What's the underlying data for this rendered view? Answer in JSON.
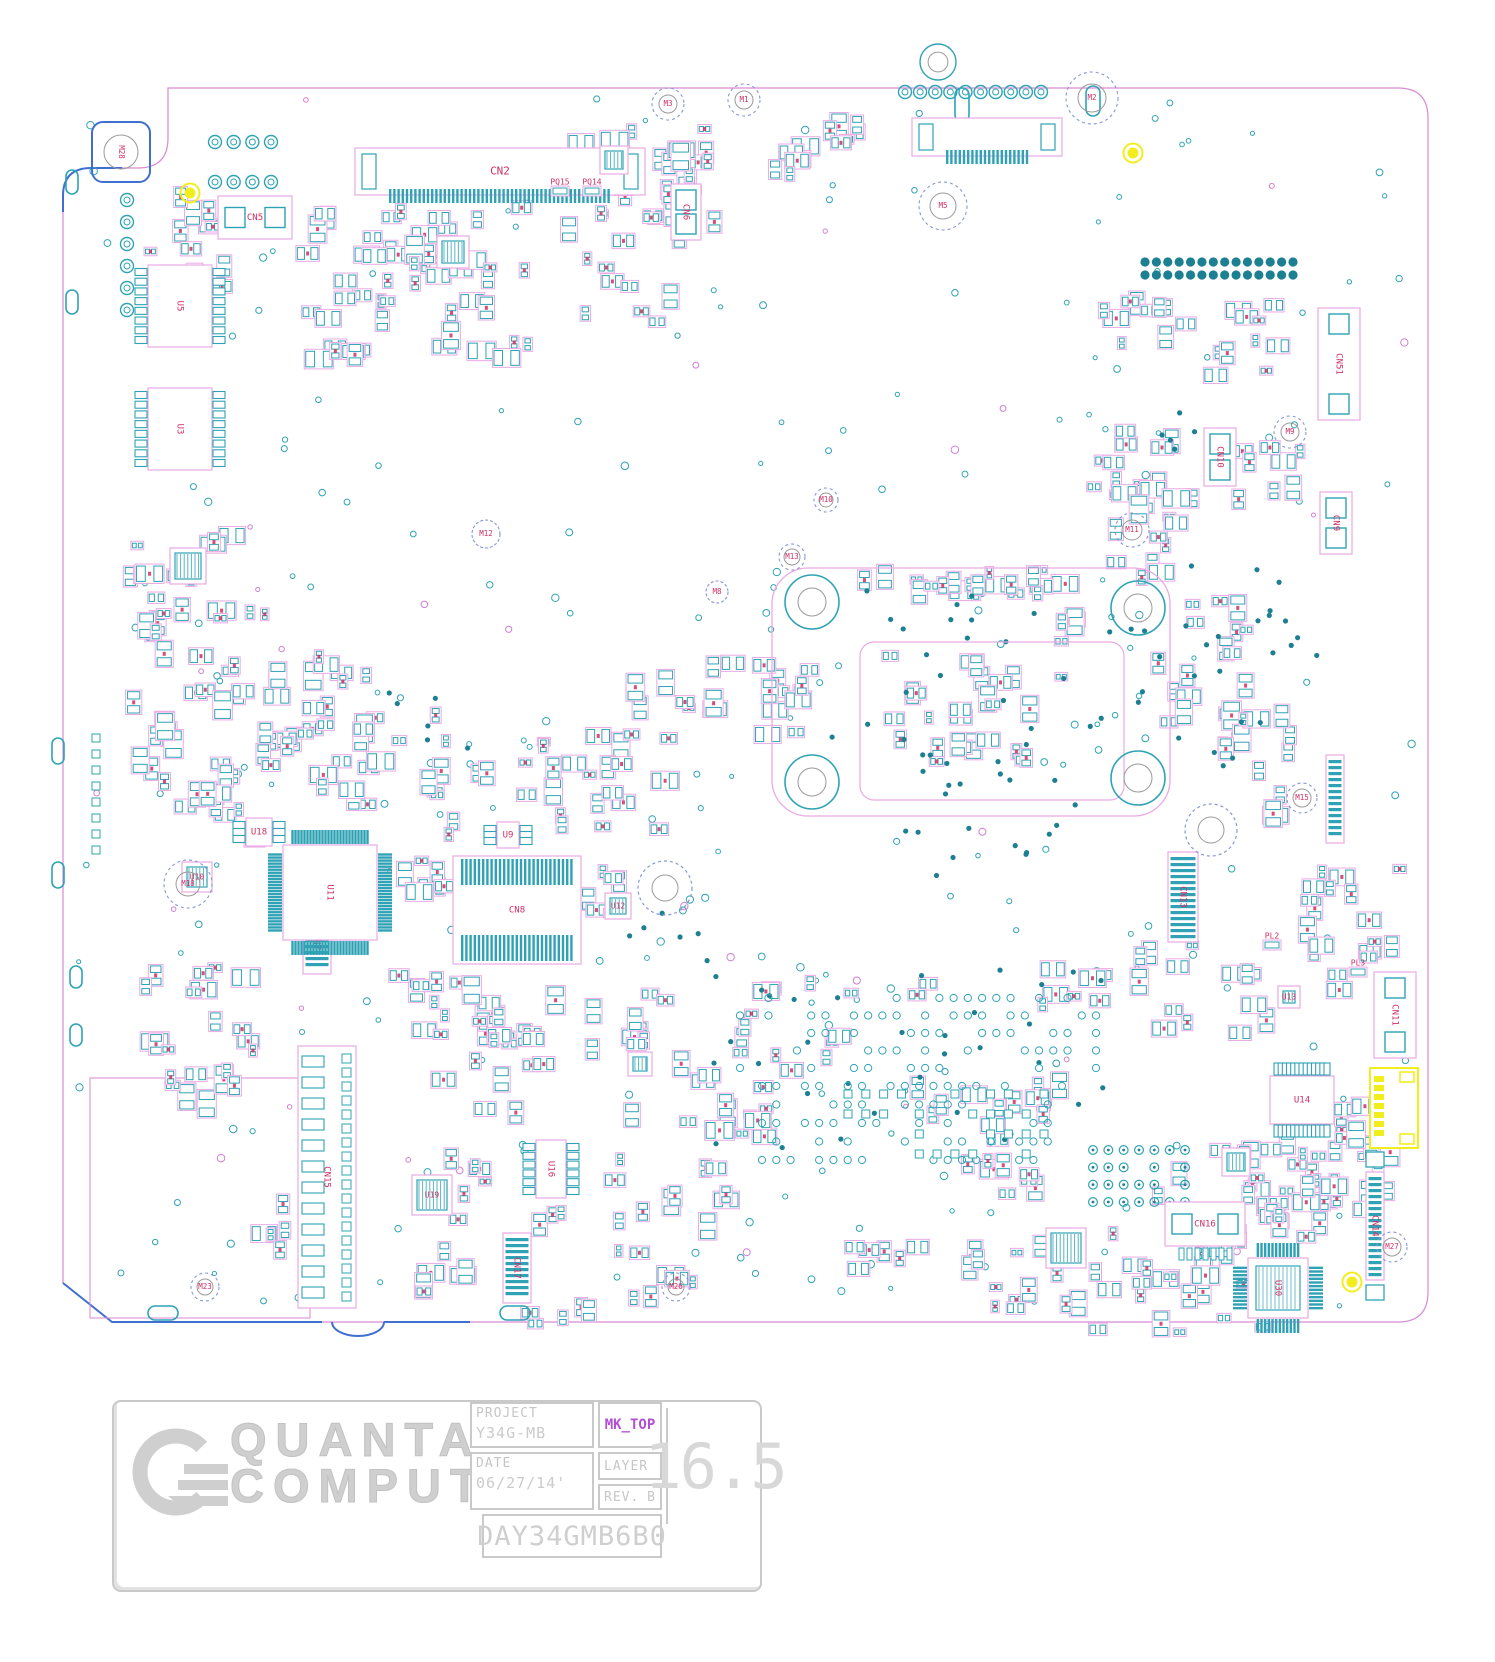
{
  "title_block": {
    "company_line1": "QUANTA",
    "company_line2": "COMPUTER",
    "project_label": "PROJECT",
    "project_value": "Y34G-MB",
    "view_name": "MK_TOP",
    "date_label": "DATE",
    "date_value": "06/27/14'",
    "layer_label": "LAYER",
    "rev_label": "REV.",
    "rev_value": "B",
    "scale_value": "16.5",
    "board_number": "DAY34GMB6B0"
  },
  "colors": {
    "pad": "#2fa3b5",
    "pad_dark": "#1d7f92",
    "silk": "#eaaae4",
    "silk2": "#cf7fd2",
    "ref": "#d02e63",
    "outline": "#d98ad4",
    "edge_blue": "#3f6fd0",
    "hole_dash": "#8896d8",
    "hole_inner": "#9a9a9a",
    "yellow": "#f2ee1e"
  },
  "board": {
    "outline": {
      "path": "M168,88 H1398 Q1428,88 1428,118 V1292 Q1428,1322 1398,1322 H112 L63,1283 V196 Q63,168 91,168 H138 Q168,168 168,138 Z",
      "blue": [
        "M63,1283 L112,1322 H322",
        "M332,1322 a26,14 0 0 0 52,0",
        "M384,1322 H470",
        "M63,212 V196 Q63,168 91,168 H122"
      ]
    },
    "zones": [
      {
        "x": 90,
        "y": 1078,
        "w": 220,
        "h": 240
      }
    ],
    "cpu_area": {
      "outer": {
        "x": 772,
        "y": 568,
        "w": 398,
        "h": 248,
        "rx": 36
      },
      "inner": {
        "x": 860,
        "y": 642,
        "w": 264,
        "h": 158,
        "rx": 14
      },
      "holes": [
        [
          812,
          602
        ],
        [
          1138,
          608
        ],
        [
          812,
          782
        ],
        [
          1138,
          778
        ]
      ],
      "hole_r1": 27,
      "hole_r2": 14
    },
    "mounting_holes": [
      {
        "label": "M28",
        "x": 121,
        "y": 152,
        "style": "pad"
      },
      {
        "label": "M3",
        "x": 668,
        "y": 104,
        "style": "a",
        "r1": 16,
        "r2": 9
      },
      {
        "label": "M1",
        "x": 744,
        "y": 100,
        "style": "a",
        "r1": 16,
        "r2": 9
      },
      {
        "label": "M2",
        "x": 1092,
        "y": 98,
        "style": "b",
        "r1": 26,
        "r2": 14
      },
      {
        "label": "M5",
        "x": 943,
        "y": 206,
        "style": "b",
        "r1": 24,
        "r2": 13
      },
      {
        "label": "M12",
        "x": 486,
        "y": 534,
        "style": "c",
        "r1": 14
      },
      {
        "label": "M13",
        "x": 792,
        "y": 557,
        "style": "a",
        "r1": 13,
        "r2": 8
      },
      {
        "label": "M10",
        "x": 826,
        "y": 500,
        "style": "a",
        "r1": 12,
        "r2": 7
      },
      {
        "label": "M11",
        "x": 1132,
        "y": 530,
        "style": "b",
        "r1": 17,
        "r2": 10
      },
      {
        "label": "M9",
        "x": 1290,
        "y": 432,
        "style": "b",
        "r1": 16,
        "r2": 9
      },
      {
        "label": "M8",
        "x": 717,
        "y": 592,
        "style": "c",
        "r1": 11
      },
      {
        "label": "M15",
        "x": 1302,
        "y": 798,
        "style": "a",
        "r1": 15,
        "r2": 9
      },
      {
        "label": "M18",
        "x": 188,
        "y": 884,
        "style": "b",
        "r1": 24,
        "r2": 12
      },
      {
        "label": "M23",
        "x": 205,
        "y": 1287,
        "style": "a",
        "r1": 14,
        "r2": 8
      },
      {
        "label": "M26",
        "x": 676,
        "y": 1287,
        "style": "a",
        "r1": 14,
        "r2": 8
      },
      {
        "label": "M27",
        "x": 1392,
        "y": 1247,
        "style": "a",
        "r1": 15,
        "r2": 9
      },
      {
        "label": "",
        "x": 1211,
        "y": 830,
        "style": "big",
        "r1": 26,
        "r2": 13
      },
      {
        "label": "",
        "x": 665,
        "y": 888,
        "style": "big",
        "r1": 27,
        "r2": 13
      }
    ],
    "fiducials": [
      [
        190,
        193
      ],
      [
        1133,
        153
      ],
      [
        1352,
        1282
      ]
    ],
    "rings": [
      [
        938,
        62,
        18
      ]
    ],
    "slots": [
      {
        "x": 66,
        "y": 170,
        "w": 12,
        "h": 24
      },
      {
        "x": 66,
        "y": 290,
        "w": 12,
        "h": 24
      },
      {
        "x": 52,
        "y": 738,
        "w": 12,
        "h": 26
      },
      {
        "x": 52,
        "y": 862,
        "w": 12,
        "h": 26
      },
      {
        "x": 70,
        "y": 966,
        "w": 12,
        "h": 22
      },
      {
        "x": 70,
        "y": 1024,
        "w": 12,
        "h": 22
      },
      {
        "x": 148,
        "y": 1306,
        "w": 30,
        "h": 14
      },
      {
        "x": 500,
        "y": 1306,
        "w": 30,
        "h": 14
      },
      {
        "x": 955,
        "y": 88,
        "w": 14,
        "h": 34
      },
      {
        "x": 1086,
        "y": 86,
        "w": 14,
        "h": 30
      }
    ],
    "connectors": [
      {
        "t": "CN2",
        "type": "ffc_h",
        "x": 355,
        "y": 148,
        "w": 290,
        "h": 47
      },
      {
        "t": "CN5",
        "type": "box_h",
        "x": 218,
        "y": 196,
        "w": 74,
        "h": 43
      },
      {
        "t": "CN6",
        "type": "box_v",
        "x": 671,
        "y": 184,
        "w": 30,
        "h": 56,
        "r": 1
      },
      {
        "t": "",
        "type": "ffc_h",
        "x": 912,
        "y": 118,
        "w": 150,
        "h": 38
      },
      {
        "t": "CN51",
        "type": "box_v",
        "x": 1318,
        "y": 308,
        "w": 42,
        "h": 112,
        "r": 1
      },
      {
        "t": "CN10",
        "type": "box_v",
        "x": 1204,
        "y": 428,
        "w": 32,
        "h": 58,
        "r": 1
      },
      {
        "t": "CN9",
        "type": "box_v",
        "x": 1320,
        "y": 492,
        "w": 32,
        "h": 62,
        "r": 1
      },
      {
        "t": "CN8",
        "type": "dual_comb",
        "x": 453,
        "y": 856,
        "w": 128,
        "h": 108
      },
      {
        "t": "CN7",
        "type": "ffc_v",
        "x": 303,
        "y": 910,
        "w": 28,
        "h": 64,
        "r": 1
      },
      {
        "t": "CN15",
        "type": "tall_v",
        "x": 298,
        "y": 1046,
        "w": 58,
        "h": 262,
        "r": 1
      },
      {
        "t": "CN13",
        "type": "ffc_v",
        "x": 1168,
        "y": 852,
        "w": 30,
        "h": 90,
        "r": 1
      },
      {
        "t": "",
        "type": "ffc_v",
        "x": 1326,
        "y": 755,
        "w": 18,
        "h": 88
      },
      {
        "t": "CN11",
        "type": "box_v",
        "x": 1374,
        "y": 972,
        "w": 42,
        "h": 86,
        "r": 1
      },
      {
        "t": "CN16",
        "type": "box_h",
        "x": 1165,
        "y": 1202,
        "w": 80,
        "h": 44
      },
      {
        "t": "CN14",
        "type": "ffc_v",
        "x": 1366,
        "y": 1172,
        "w": 18,
        "h": 108,
        "r": 1,
        "e": 1
      },
      {
        "t": "CN17",
        "type": "ffc_v",
        "x": 503,
        "y": 1233,
        "w": 28,
        "h": 70,
        "r": 1
      },
      {
        "t": "",
        "type": "yellow_box",
        "x": 1370,
        "y": 1068,
        "w": 48,
        "h": 80
      }
    ],
    "ics": [
      {
        "t": "U5",
        "type": "soic",
        "x": 148,
        "y": 265,
        "w": 64,
        "h": 82,
        "p": 8,
        "o": "v",
        "r": 1
      },
      {
        "t": "U3",
        "type": "soic",
        "x": 148,
        "y": 388,
        "w": 64,
        "h": 82,
        "p": 8,
        "o": "v",
        "r": 1
      },
      {
        "t": "U11",
        "type": "qfp",
        "x": 283,
        "y": 845,
        "w": 94,
        "h": 95,
        "p": 26,
        "r": 1
      },
      {
        "t": "U30",
        "type": "qfp",
        "x": 1248,
        "y": 1258,
        "w": 60,
        "h": 60,
        "p": 12,
        "f": 1,
        "r": 1
      },
      {
        "t": "U9",
        "type": "soic",
        "x": 497,
        "y": 822,
        "w": 22,
        "h": 26,
        "p": 3,
        "o": "v"
      },
      {
        "t": "U18",
        "type": "soic",
        "x": 246,
        "y": 818,
        "w": 26,
        "h": 28,
        "p": 3,
        "o": "v"
      },
      {
        "t": "U10",
        "type": "qfn",
        "x": 182,
        "y": 862,
        "s": 30
      },
      {
        "t": "U12",
        "type": "qfn",
        "x": 605,
        "y": 893,
        "s": 26
      },
      {
        "t": "U13",
        "type": "qfn",
        "x": 1278,
        "y": 986,
        "s": 22
      },
      {
        "t": "U14",
        "type": "soic",
        "x": 1270,
        "y": 1076,
        "w": 64,
        "h": 48,
        "p": 13,
        "o": "h"
      },
      {
        "t": "U19",
        "type": "qfn",
        "x": 412,
        "y": 1175,
        "s": 40
      },
      {
        "t": "U16",
        "type": "soic",
        "x": 536,
        "y": 1140,
        "w": 30,
        "h": 58,
        "p": 6,
        "o": "v",
        "r": 1
      },
      {
        "t": "",
        "type": "qfn",
        "x": 437,
        "y": 236,
        "s": 32
      },
      {
        "t": "",
        "type": "qfn",
        "x": 600,
        "y": 146,
        "s": 28
      },
      {
        "t": "",
        "type": "qfn",
        "x": 170,
        "y": 548,
        "s": 36
      },
      {
        "t": "",
        "type": "qfn",
        "x": 1046,
        "y": 1228,
        "s": 40
      },
      {
        "t": "",
        "type": "qfn",
        "x": 1222,
        "y": 1148,
        "s": 28
      },
      {
        "t": "",
        "type": "qfn",
        "x": 628,
        "y": 1052,
        "s": 24
      }
    ],
    "small_labels": [
      {
        "t": "PQ15",
        "x": 560,
        "y": 182
      },
      {
        "t": "PQ14",
        "x": 592,
        "y": 182
      },
      {
        "t": "PL2",
        "x": 1272,
        "y": 936
      },
      {
        "t": "PL3",
        "x": 1358,
        "y": 963
      }
    ],
    "pad_grids": [
      {
        "x": 740,
        "y": 998,
        "w": 356,
        "h": 70,
        "r": 5,
        "c": 26,
        "s": "dot",
        "p": 0.5
      },
      {
        "x": 762,
        "y": 1086,
        "w": 300,
        "h": 74,
        "r": 5,
        "c": 22,
        "s": "dot",
        "p": 0.5
      },
      {
        "x": 848,
        "y": 1094,
        "w": 196,
        "h": 60,
        "r": 4,
        "c": 12,
        "s": "sq",
        "p": 0.55
      },
      {
        "x": 1093,
        "y": 1150,
        "w": 92,
        "h": 52,
        "r": 4,
        "c": 7,
        "s": "tg",
        "p": 0.85
      },
      {
        "x": 215,
        "y": 142,
        "w": 56,
        "h": 40,
        "r": 2,
        "c": 4,
        "s": "ring",
        "p": 1
      },
      {
        "x": 905,
        "y": 92,
        "w": 136,
        "h": 12,
        "r": 1,
        "c": 10,
        "s": "ring",
        "p": 1
      },
      {
        "x": 1145,
        "y": 262,
        "w": 148,
        "h": 13,
        "r": 2,
        "c": 14,
        "s": "fdot",
        "p": 1
      },
      {
        "x": 127,
        "y": 200,
        "w": 10,
        "h": 110,
        "r": 6,
        "c": 1,
        "s": "ring",
        "p": 1
      },
      {
        "x": 96,
        "y": 738,
        "w": 14,
        "h": 112,
        "r": 8,
        "c": 1,
        "s": "sq",
        "p": 1
      }
    ],
    "clusters": [
      [
        130,
        185,
        110,
        120,
        12
      ],
      [
        285,
        205,
        180,
        110,
        18
      ],
      [
        390,
        200,
        150,
        90,
        16
      ],
      [
        560,
        120,
        120,
        130,
        18
      ],
      [
        662,
        120,
        70,
        100,
        10
      ],
      [
        755,
        130,
        70,
        60,
        6
      ],
      [
        815,
        110,
        60,
        50,
        6
      ],
      [
        1090,
        280,
        110,
        70,
        10
      ],
      [
        1195,
        295,
        100,
        90,
        10
      ],
      [
        1080,
        420,
        110,
        110,
        12
      ],
      [
        1100,
        480,
        100,
        70,
        8
      ],
      [
        1230,
        440,
        80,
        80,
        8
      ],
      [
        120,
        520,
        130,
        130,
        16
      ],
      [
        150,
        590,
        120,
        120,
        14
      ],
      [
        230,
        645,
        150,
        110,
        16
      ],
      [
        120,
        690,
        130,
        120,
        14
      ],
      [
        250,
        705,
        150,
        110,
        16
      ],
      [
        345,
        700,
        110,
        100,
        10
      ],
      [
        440,
        730,
        130,
        120,
        12
      ],
      [
        555,
        720,
        130,
        120,
        14
      ],
      [
        620,
        660,
        110,
        90,
        8
      ],
      [
        700,
        650,
        110,
        110,
        10
      ],
      [
        850,
        560,
        240,
        50,
        14
      ],
      [
        880,
        650,
        230,
        130,
        26
      ],
      [
        1150,
        650,
        120,
        110,
        10
      ],
      [
        1200,
        700,
        130,
        130,
        12
      ],
      [
        1185,
        560,
        90,
        110,
        8
      ],
      [
        380,
        950,
        150,
        110,
        12
      ],
      [
        440,
        975,
        130,
        80,
        10
      ],
      [
        420,
        1020,
        150,
        110,
        12
      ],
      [
        560,
        980,
        120,
        90,
        8
      ],
      [
        620,
        1030,
        130,
        120,
        10
      ],
      [
        600,
        1150,
        150,
        110,
        14
      ],
      [
        130,
        950,
        140,
        110,
        12
      ],
      [
        150,
        1020,
        120,
        100,
        10
      ],
      [
        1130,
        940,
        150,
        110,
        14
      ],
      [
        1290,
        860,
        120,
        90,
        10
      ],
      [
        1300,
        930,
        100,
        70,
        8
      ],
      [
        1150,
        1130,
        190,
        100,
        18
      ],
      [
        1230,
        1140,
        170,
        110,
        20
      ],
      [
        1080,
        1220,
        200,
        120,
        26
      ],
      [
        950,
        1230,
        140,
        90,
        14
      ],
      [
        1290,
        1090,
        120,
        80,
        12
      ],
      [
        440,
        1130,
        130,
        110,
        10
      ],
      [
        905,
        1050,
        200,
        100,
        14
      ],
      [
        730,
        970,
        220,
        110,
        14
      ],
      [
        290,
        280,
        120,
        90,
        10
      ],
      [
        430,
        290,
        130,
        90,
        10
      ],
      [
        575,
        250,
        110,
        80,
        8
      ],
      [
        640,
        180,
        90,
        70,
        8
      ],
      [
        1100,
        530,
        90,
        60,
        6
      ],
      [
        960,
        560,
        90,
        50,
        6
      ],
      [
        170,
        780,
        100,
        70,
        8
      ],
      [
        390,
        850,
        70,
        70,
        6
      ],
      [
        580,
        840,
        70,
        80,
        6
      ],
      [
        250,
        1190,
        60,
        70,
        5
      ],
      [
        390,
        1240,
        90,
        70,
        6
      ],
      [
        520,
        1290,
        80,
        50,
        5
      ],
      [
        620,
        1250,
        80,
        60,
        5
      ],
      [
        760,
        660,
        60,
        60,
        5
      ],
      [
        1030,
        960,
        90,
        70,
        7
      ],
      [
        960,
        1140,
        90,
        70,
        8
      ],
      [
        840,
        1220,
        90,
        60,
        6
      ],
      [
        700,
        1080,
        80,
        70,
        6
      ],
      [
        1010,
        600,
        80,
        50,
        5
      ]
    ],
    "dots": [
      [
        830,
        580,
        330,
        240,
        40
      ],
      [
        1160,
        560,
        120,
        260,
        16
      ],
      [
        700,
        960,
        420,
        200,
        34
      ],
      [
        380,
        690,
        90,
        70,
        6
      ],
      [
        900,
        820,
        210,
        60,
        10
      ],
      [
        1150,
        390,
        60,
        60,
        5
      ],
      [
        1240,
        600,
        80,
        80,
        6
      ],
      [
        620,
        900,
        80,
        60,
        5
      ]
    ],
    "vias": {
      "n": 270,
      "x0": 78,
      "y0": 96,
      "x1": 1412,
      "y1": 1308
    }
  }
}
